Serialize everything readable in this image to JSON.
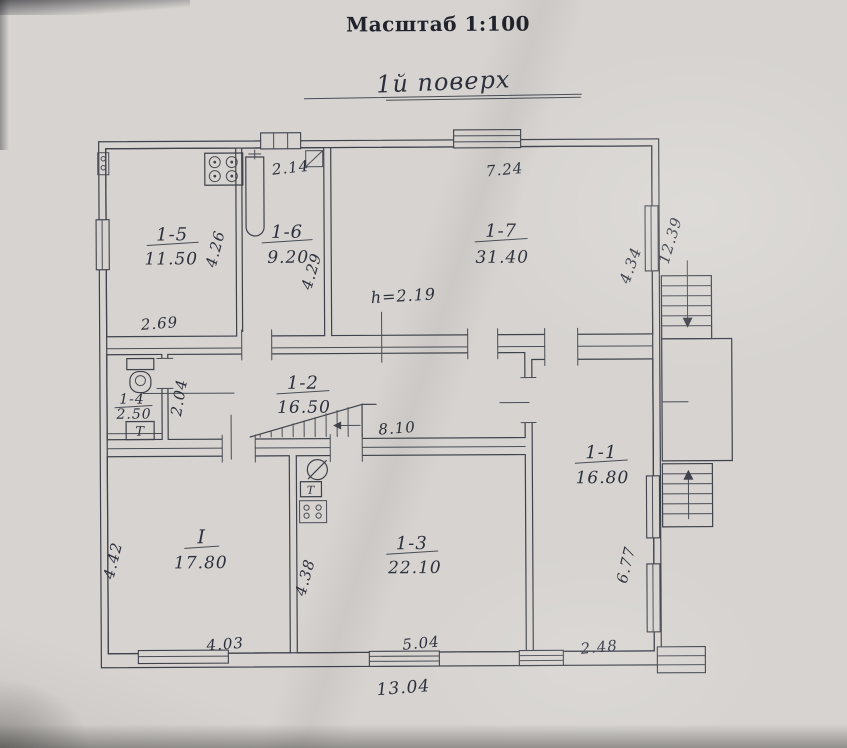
{
  "title": "Масштаб 1:100",
  "floor_label": "1й поверх",
  "rooms": [
    {
      "id": "1-5",
      "area": "11.50"
    },
    {
      "id": "1-6",
      "area": "9.20"
    },
    {
      "id": "1-7",
      "area": "31.40"
    },
    {
      "id": "1-4",
      "area": "2.50"
    },
    {
      "id": "1-2",
      "area": "16.50"
    },
    {
      "id": "1-1",
      "area": "16.80"
    },
    {
      "id": "I",
      "area": "17.80"
    },
    {
      "id": "1-3",
      "area": "22.10"
    }
  ],
  "dims": {
    "room15_width": "2.69",
    "room15_depth": "4.26",
    "room16_top": "2.14",
    "room16_depth": "4.29",
    "room17_width": "7.24",
    "room17_depth": "4.34",
    "right_side_length": "12.39",
    "ceiling_height": "h=2.19",
    "hall_depth": "2.04",
    "hall_length": "8.10",
    "roomI_depth": "4.42",
    "roomI_width": "4.03",
    "room13_depth": "4.38",
    "room13_width": "5.04",
    "room11_depth": "6.77",
    "room11_width": "2.48",
    "total_width": "13.04"
  },
  "fixtures": {
    "meter_label": "Т",
    "meter_label_2": "Т"
  }
}
